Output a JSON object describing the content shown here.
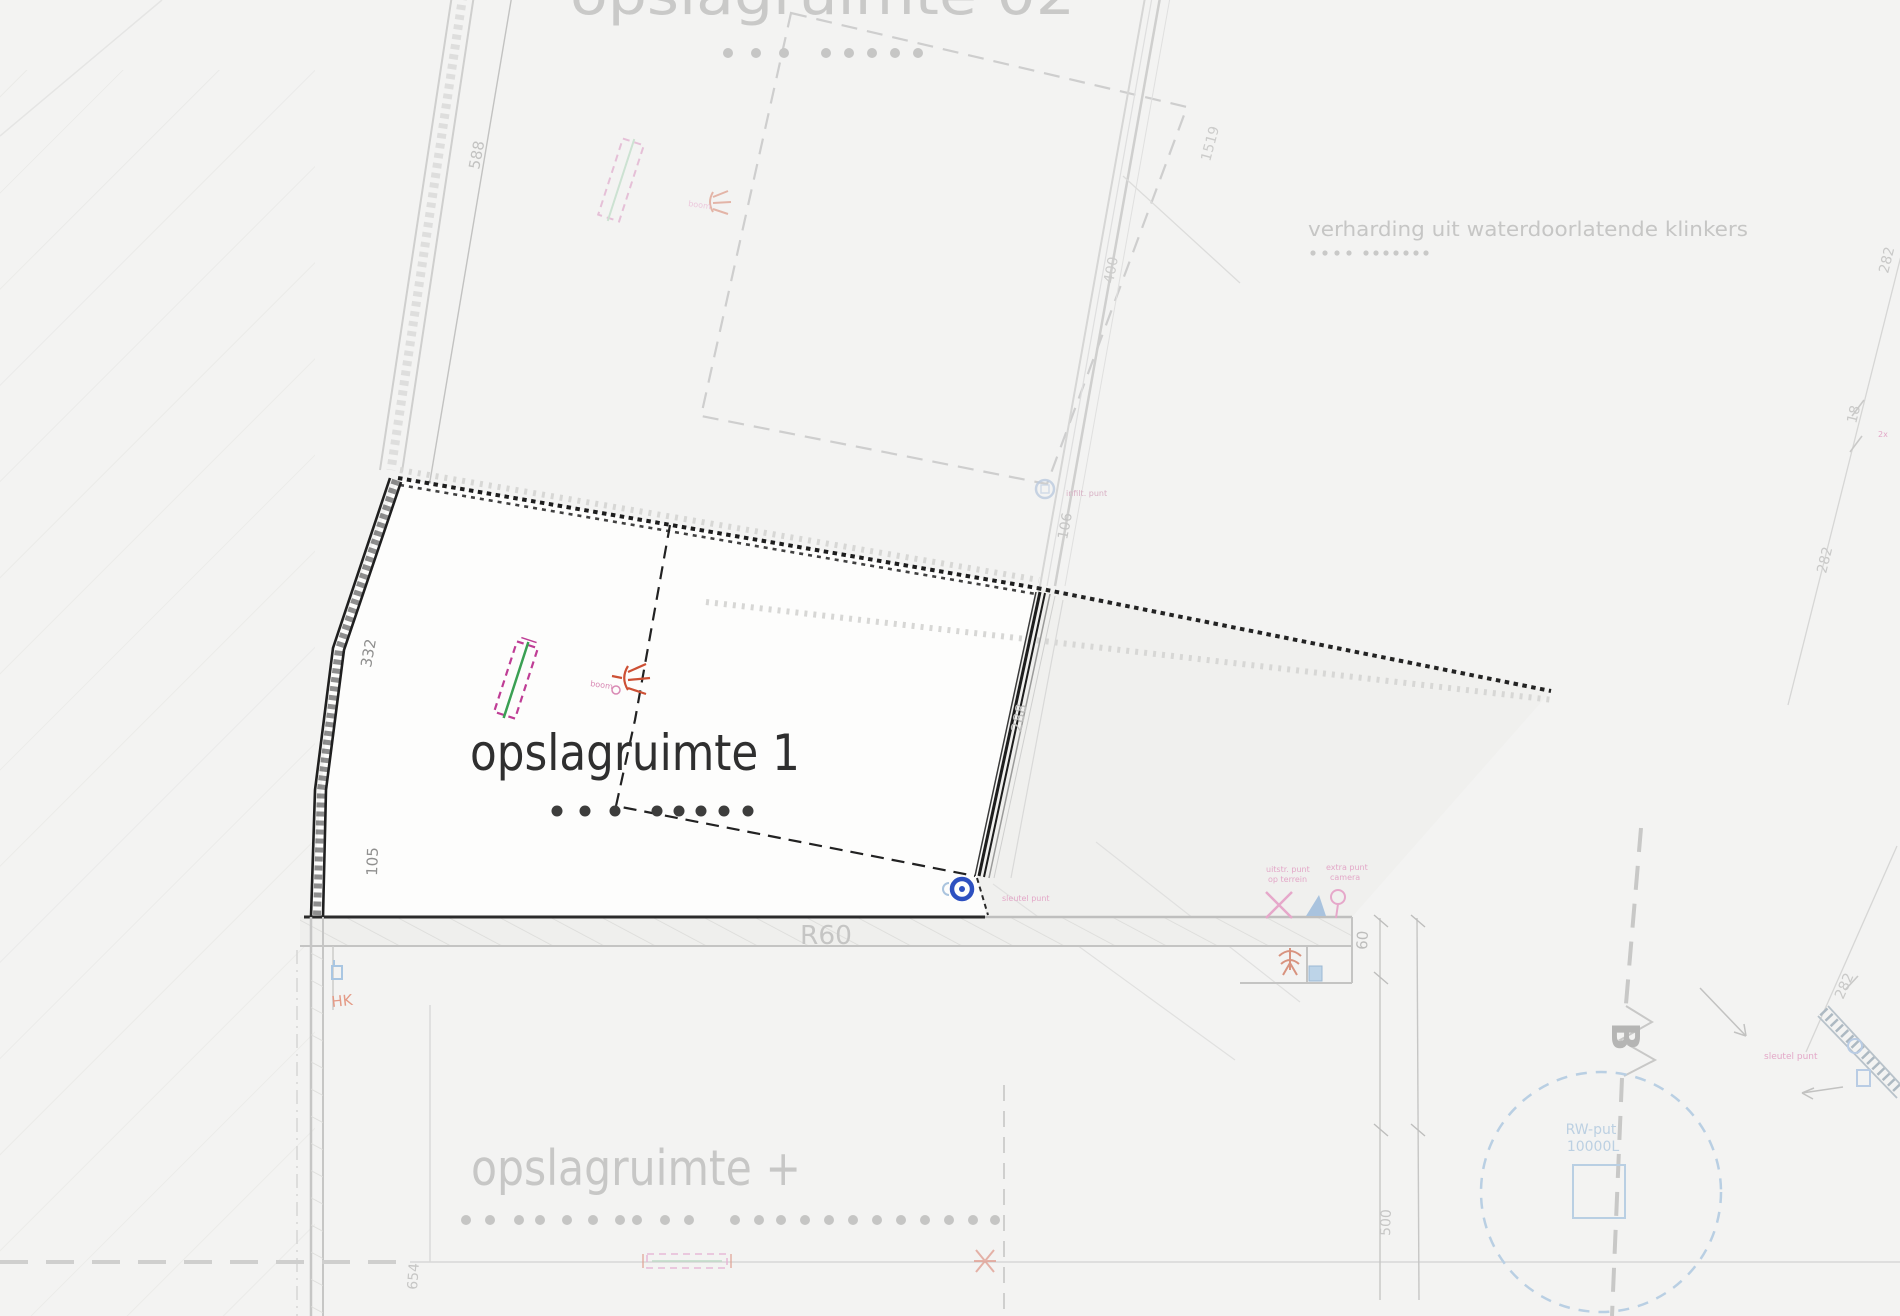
{
  "titles": {
    "storage1": "opslagruimte 1",
    "storage2": "opslagruimte 02",
    "storage_plus": "opslagruimte +"
  },
  "annotations": {
    "paving_note": "verharding uit waterdoorlatende klinkers",
    "fire_rating": "R60",
    "section_letter": "B",
    "rw_put_line1": "RW-put",
    "rw_put_line2": "10000L"
  },
  "dimension_labels": [
    {
      "text": "588",
      "x": 479,
      "y": 170,
      "rot": -79,
      "color": "#c2c2c1",
      "size": 15
    },
    {
      "text": "332",
      "x": 371,
      "y": 668,
      "rot": -80,
      "color": "#8f8f8e",
      "size": 15
    },
    {
      "text": "105",
      "x": 377,
      "y": 876,
      "rot": -88,
      "color": "#8f8f8e",
      "size": 15
    },
    {
      "text": "288",
      "x": 1021,
      "y": 733,
      "rot": -78,
      "color": "#bdbdbc",
      "size": 15
    },
    {
      "text": "106",
      "x": 1067,
      "y": 540,
      "rot": -79,
      "color": "#c6c6c5",
      "size": 14
    },
    {
      "text": "400",
      "x": 1113,
      "y": 284,
      "rot": -79,
      "color": "#cccccb",
      "size": 14
    },
    {
      "text": "1519",
      "x": 1210,
      "y": 162,
      "rot": -75,
      "color": "#cccccb",
      "size": 14
    },
    {
      "text": "60",
      "x": 1367,
      "y": 950,
      "rot": -87,
      "color": "#bdbdbc",
      "size": 15
    },
    {
      "text": "500",
      "x": 1390,
      "y": 1236,
      "rot": -88,
      "color": "#c6c6c5",
      "size": 14
    },
    {
      "text": "654",
      "x": 417,
      "y": 1290,
      "rot": -86,
      "color": "#c6c6c5",
      "size": 14
    },
    {
      "text": "282",
      "x": 1888,
      "y": 274,
      "rot": -76,
      "color": "#c9c9c8",
      "size": 14
    },
    {
      "text": "18",
      "x": 1856,
      "y": 424,
      "rot": -76,
      "color": "#c9c9c8",
      "size": 14
    },
    {
      "text": "282",
      "x": 1826,
      "y": 574,
      "rot": -76,
      "color": "#c9c9c8",
      "size": 14
    },
    {
      "text": "282",
      "x": 1843,
      "y": 1000,
      "rot": -66,
      "color": "#c9c9c8",
      "size": 14
    }
  ],
  "tiny_labels": [
    {
      "text": "boom",
      "x": 590,
      "y": 686,
      "color": "#d98ab4",
      "rot": 8,
      "size": 8
    },
    {
      "text": "boom",
      "x": 688,
      "y": 206,
      "color": "#ecc8dc",
      "rot": 8,
      "size": 8
    },
    {
      "text": "sleutel punt",
      "x": 1002,
      "y": 901,
      "color": "#e3a8c8",
      "rot": 0,
      "size": 8
    },
    {
      "text": "uitstr. punt",
      "x": 1266,
      "y": 872,
      "color": "#e3a8c8",
      "rot": 0,
      "size": 8
    },
    {
      "text": "op terrein",
      "x": 1268,
      "y": 882,
      "color": "#e3a8c8",
      "rot": 0,
      "size": 8
    },
    {
      "text": "extra punt",
      "x": 1326,
      "y": 870,
      "color": "#e3a8c8",
      "rot": 0,
      "size": 8
    },
    {
      "text": "camera",
      "x": 1330,
      "y": 880,
      "color": "#e3a8c8",
      "rot": 0,
      "size": 8
    },
    {
      "text": "infilt. punt",
      "x": 1066,
      "y": 496,
      "color": "#d8b0c4",
      "rot": 0,
      "size": 8
    },
    {
      "text": "sleutel punt",
      "x": 1764,
      "y": 1059,
      "color": "#e3a8c8",
      "rot": 0,
      "size": 9
    },
    {
      "text": "2x",
      "x": 1878,
      "y": 437,
      "color": "#e3a8c8",
      "rot": 0,
      "size": 8
    },
    {
      "text": "HK",
      "x": 332,
      "y": 1007,
      "color": "#e49a86",
      "rot": -6,
      "size": 15
    }
  ],
  "dot_rows": [
    {
      "name": "storage2",
      "y": 53,
      "r": 5,
      "color": "#c6c6c5",
      "xs": [
        728,
        756,
        784,
        826,
        849,
        872,
        895,
        918
      ]
    },
    {
      "name": "paving",
      "y": 253,
      "r": 2.6,
      "color": "#c9c9c8",
      "xs": [
        1313,
        1325,
        1337,
        1349,
        1366,
        1376,
        1386,
        1396,
        1406,
        1416,
        1426
      ]
    },
    {
      "name": "storage1",
      "y": 811,
      "r": 5.5,
      "color": "#3d3d3c",
      "xs": [
        557,
        585,
        615,
        657,
        679,
        701,
        724,
        748
      ]
    },
    {
      "name": "storage_plus",
      "y": 1220,
      "r": 5,
      "color": "#c5c5c4",
      "xs": [
        466,
        490,
        519,
        540,
        567,
        593,
        620,
        637,
        665,
        689,
        735,
        759,
        781,
        805,
        829,
        853,
        877,
        901,
        925,
        949,
        973,
        995
      ]
    }
  ],
  "colors": {
    "paper": "#f3f3f2",
    "parcel_fill": "#fdfdfc",
    "ghost_region": "#f0f0ee",
    "dark_line": "#1e1e1e",
    "dark_text": "#2f2f2f",
    "ghost_line": "#cfcfce",
    "ghost_text": "#c9c9c8",
    "pink": "#bf3d95",
    "faded_pink": "#e6a8ca",
    "red": "#cd5034",
    "green": "#3aa053",
    "blue": "#2d50c0",
    "light_blue": "#b9cfe3"
  }
}
